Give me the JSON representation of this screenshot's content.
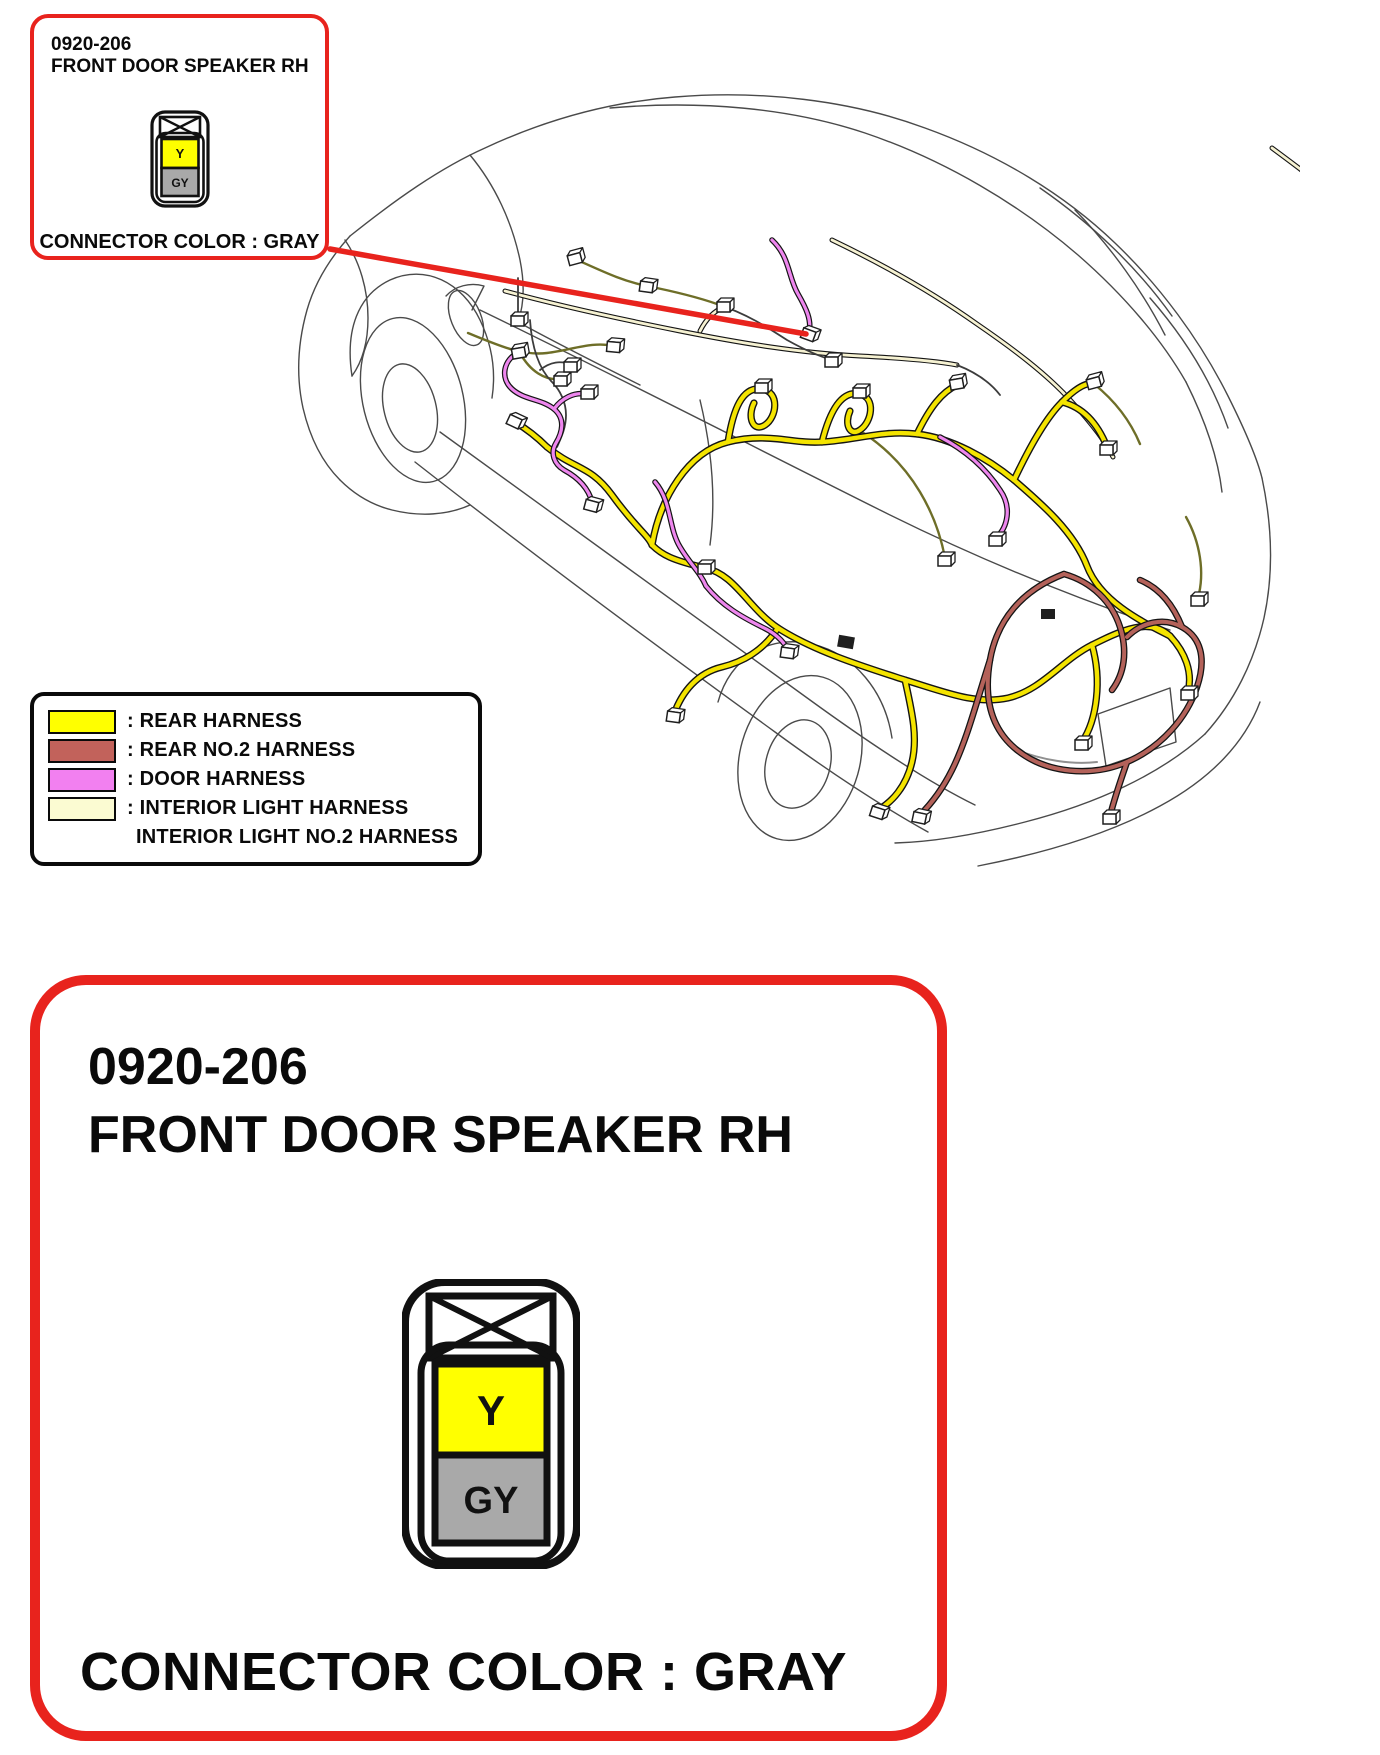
{
  "colors": {
    "accent_red": "#e8231d",
    "line_black": "#0a0a0a"
  },
  "callout": {
    "part_number": "0920-206",
    "part_name": "FRONT DOOR SPEAKER RH",
    "note": "CONNECTOR COLOR : GRAY",
    "connector": {
      "top_label": "Y",
      "bottom_label": "GY",
      "top_color": "#ffff00",
      "bottom_color": "#a9a9a9"
    }
  },
  "detail": {
    "part_number": "0920-206",
    "part_name": "FRONT DOOR SPEAKER RH",
    "note": "CONNECTOR COLOR : GRAY",
    "connector": {
      "top_label": "Y",
      "bottom_label": "GY",
      "top_color": "#ffff00",
      "bottom_color": "#a9a9a9"
    }
  },
  "legend": {
    "items": [
      {
        "label": ": REAR HARNESS",
        "color": "#ffff00"
      },
      {
        "label": ": REAR NO.2 HARNESS",
        "color": "#c2625b"
      },
      {
        "label": ": DOOR HARNESS",
        "color": "#f280f0"
      },
      {
        "label": ": INTERIOR LIGHT HARNESS",
        "color": "#fbfbd2"
      },
      {
        "label": "INTERIOR LIGHT NO.2 HARNESS",
        "color": ""
      }
    ]
  },
  "diagram": {
    "harness_stroke": {
      "rear": "#f4e400",
      "rear_no2": "#b4625a",
      "door": "#ee86ee",
      "interior_light": "#f6f2d2"
    }
  }
}
